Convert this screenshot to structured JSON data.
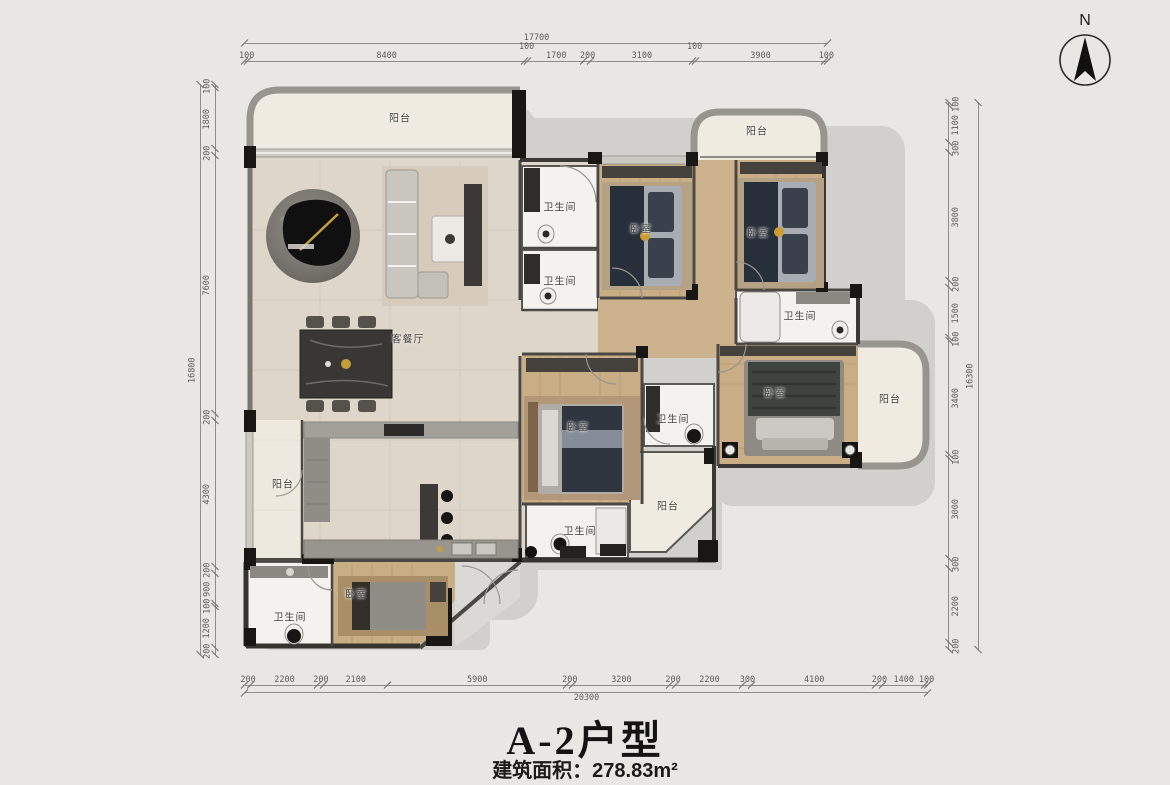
{
  "meta": {
    "title_text": "A-2户型",
    "area_text": "建筑面积：278.83m²"
  },
  "compass": {
    "north_label": "N"
  },
  "room_labels": {
    "balcony_top_left": "阳台",
    "living_dining": "客餐厅",
    "bath_entry_upper": "卫生间",
    "bath_entry_lower": "卫生间",
    "bedroom_top_mid": "卧室",
    "balcony_top_right": "阳台",
    "bedroom_top_right": "卧室",
    "bath_right": "卫生间",
    "bedroom_master": "卧室",
    "balcony_right": "阳台",
    "bedroom_mid": "卧室",
    "bath_mid": "卫生间",
    "balcony_bottom_mid": "阳台",
    "bath_bottom_mid": "卫生间",
    "balcony_left": "阳台",
    "bedroom_bottom_left": "卧室",
    "bath_bottom_left": "卫生间"
  },
  "dimensions": {
    "top": {
      "total": "17700",
      "segments": [
        "100",
        "8400",
        "100",
        "1700",
        "200",
        "3100",
        "100",
        "3900",
        "100"
      ]
    },
    "bottom": {
      "total": "20300",
      "segments": [
        "200",
        "2200",
        "200",
        "2100",
        "5900",
        "200",
        "3200",
        "200",
        "2200",
        "300",
        "4100",
        "200",
        "1400",
        "100"
      ]
    },
    "left": {
      "total": "16800",
      "segments": [
        "100",
        "1800",
        "200",
        "7600",
        "200",
        "4300",
        "200",
        "900",
        "100",
        "1200",
        "200"
      ]
    },
    "right": {
      "total": "16300",
      "segments": [
        "100",
        "1100",
        "300",
        "3800",
        "200",
        "1500",
        "100",
        "3400",
        "100",
        "3000",
        "300",
        "2200",
        "200"
      ]
    }
  },
  "colors": {
    "background": "#e9e7e3",
    "shadow": "#d2d0cc",
    "wood_floor": "#c8ad85",
    "tile_floor": "#ddd6c9",
    "balcony_floor": "#efebe0",
    "bath_floor": "#f3f2ee",
    "wall_dark": "#181714",
    "wall_gray": "#98958e",
    "gold_accent": "#c79f3c",
    "navy_bedding": "#272f3a",
    "dim_line": "#8f8d87"
  }
}
